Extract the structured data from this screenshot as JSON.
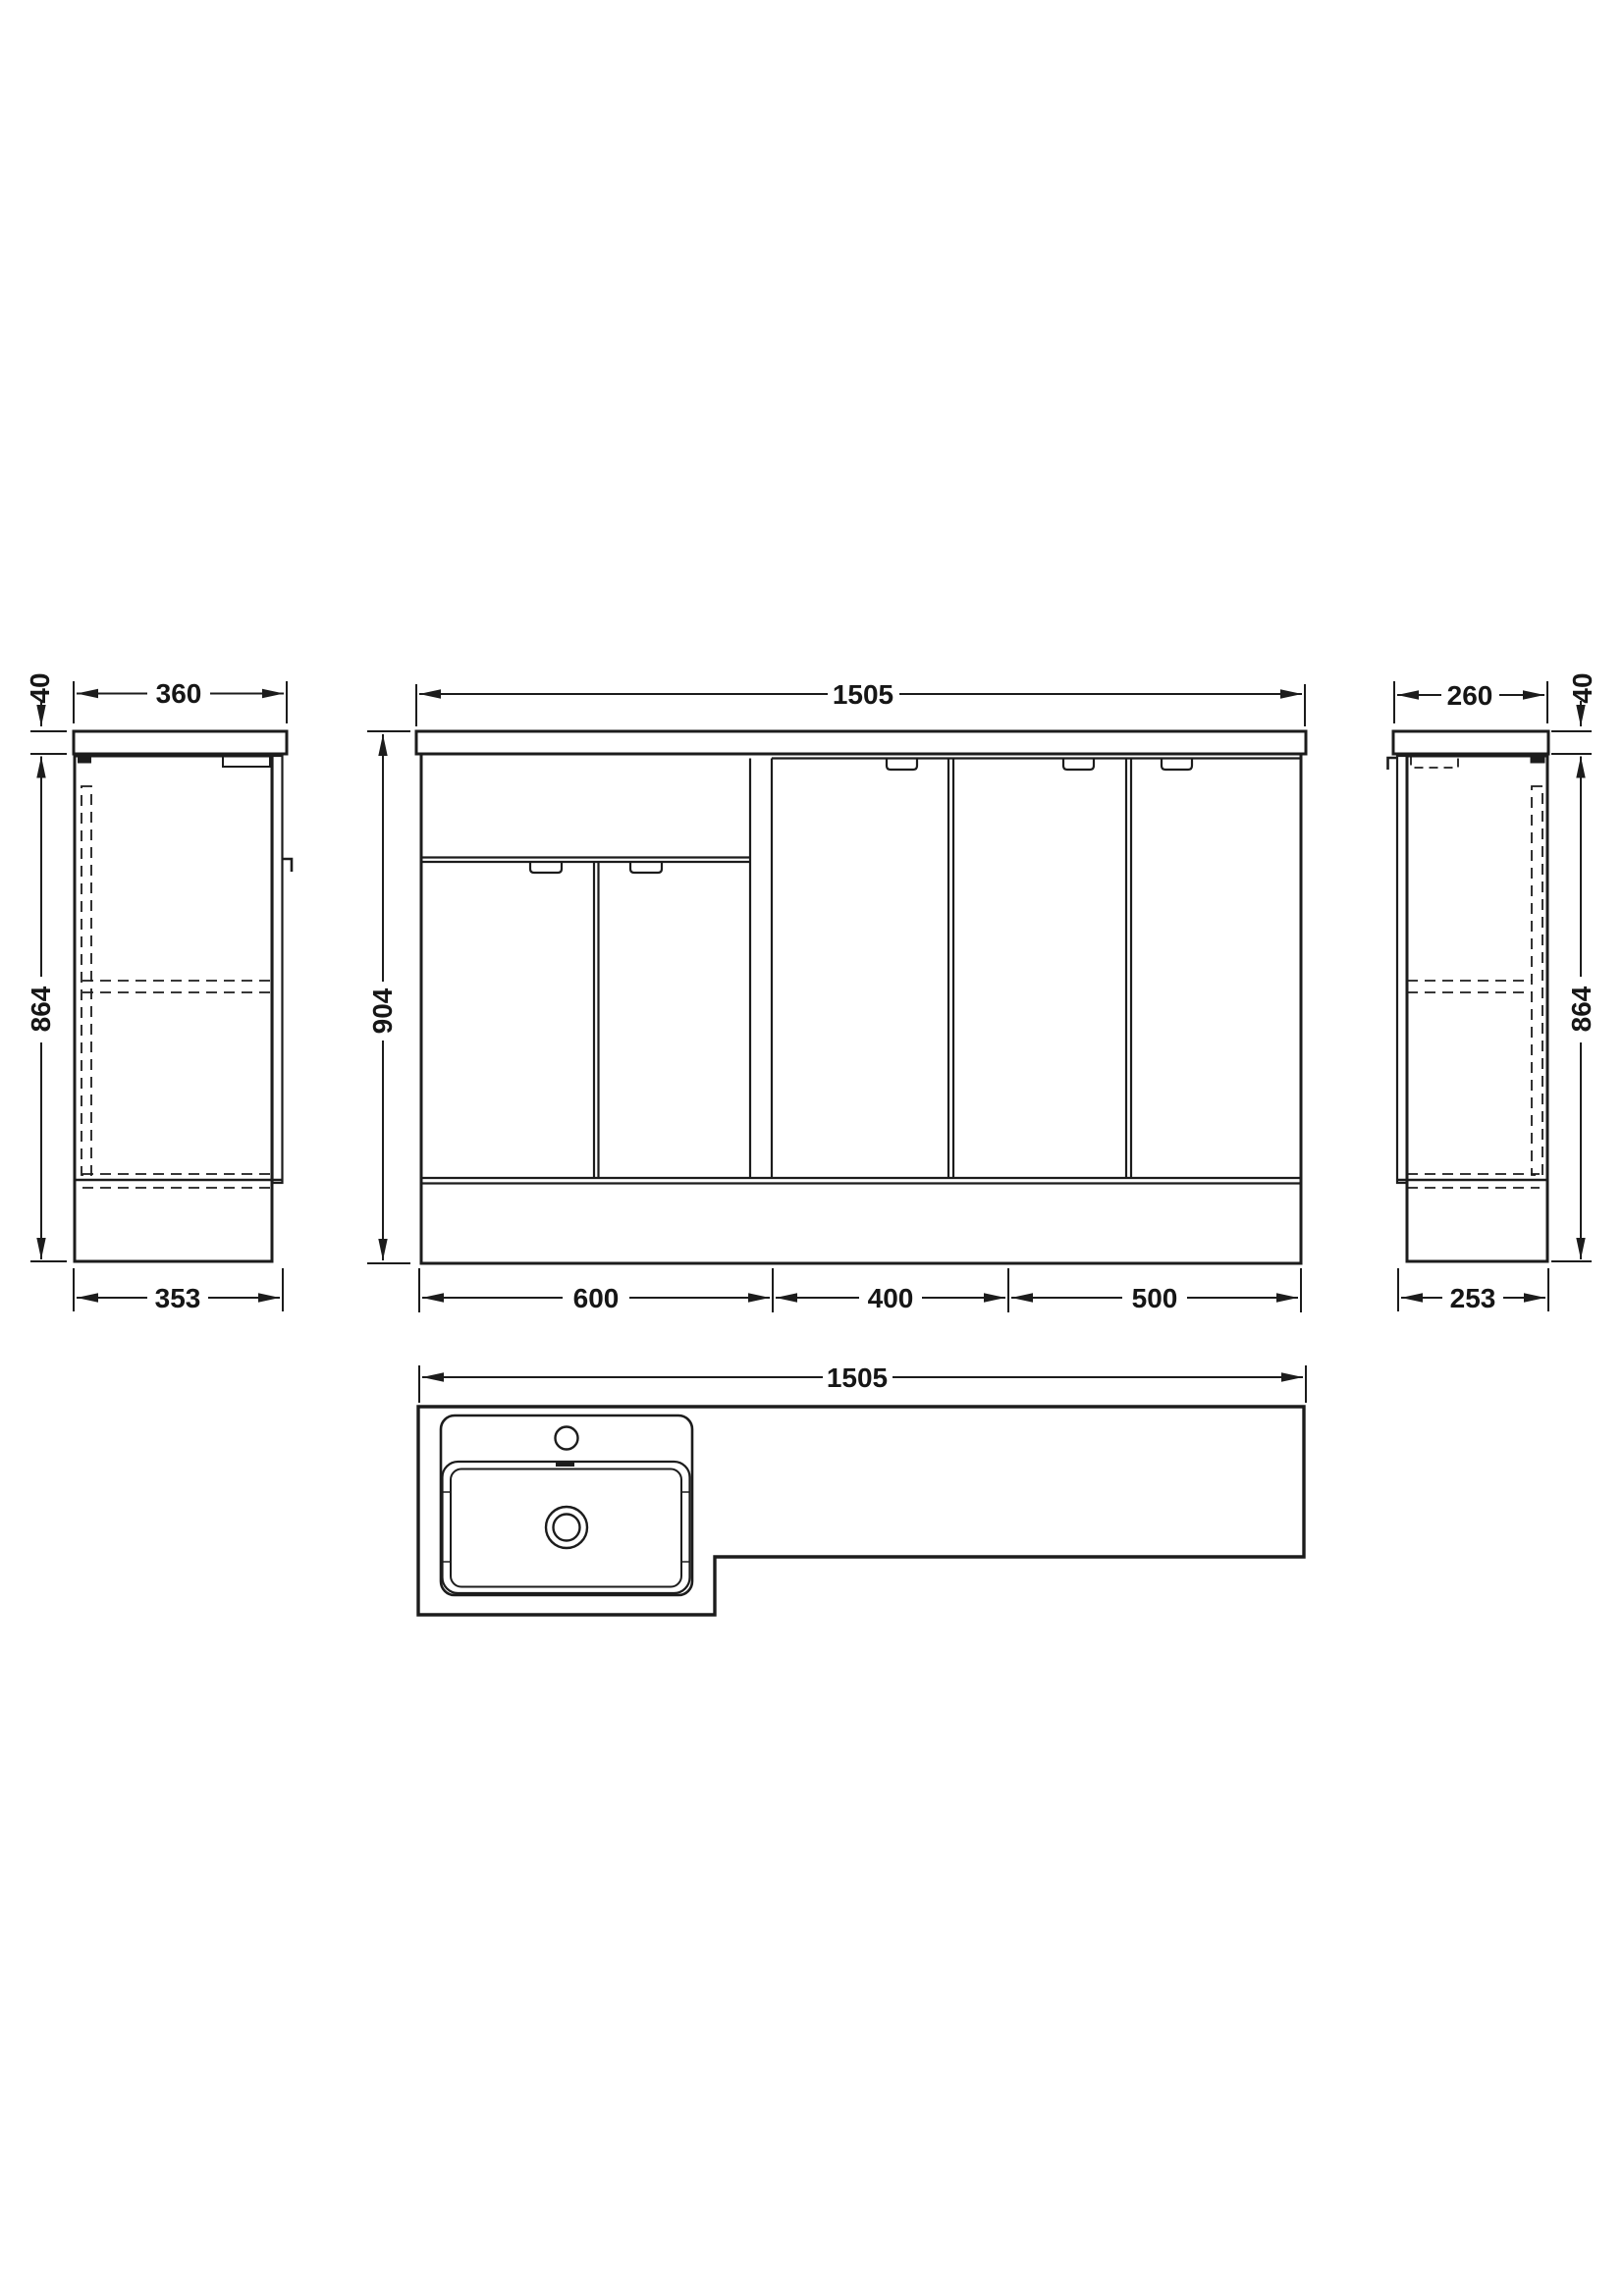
{
  "page": {
    "background": "#ffffff",
    "line_color": "#1c1c1c",
    "description": "Technical dimension drawing of an L-shaped bathroom vanity furniture pack: left end view, front elevation, right end view and worktop plan with basin"
  },
  "views": {
    "left_side": {
      "label": "left-end-view",
      "dims": {
        "width": "360",
        "worktop_thickness": "40",
        "height": "864",
        "depth": "353"
      }
    },
    "front": {
      "label": "front-elevation",
      "dims": {
        "width": "1505",
        "height": "904",
        "unit_widths": [
          "600",
          "400",
          "500"
        ]
      }
    },
    "right_side": {
      "label": "right-end-view",
      "dims": {
        "width": "260",
        "worktop_thickness": "40",
        "height": "864",
        "depth": "253"
      }
    },
    "plan": {
      "label": "worktop-plan-view",
      "dims": {
        "width": "1505"
      }
    }
  }
}
